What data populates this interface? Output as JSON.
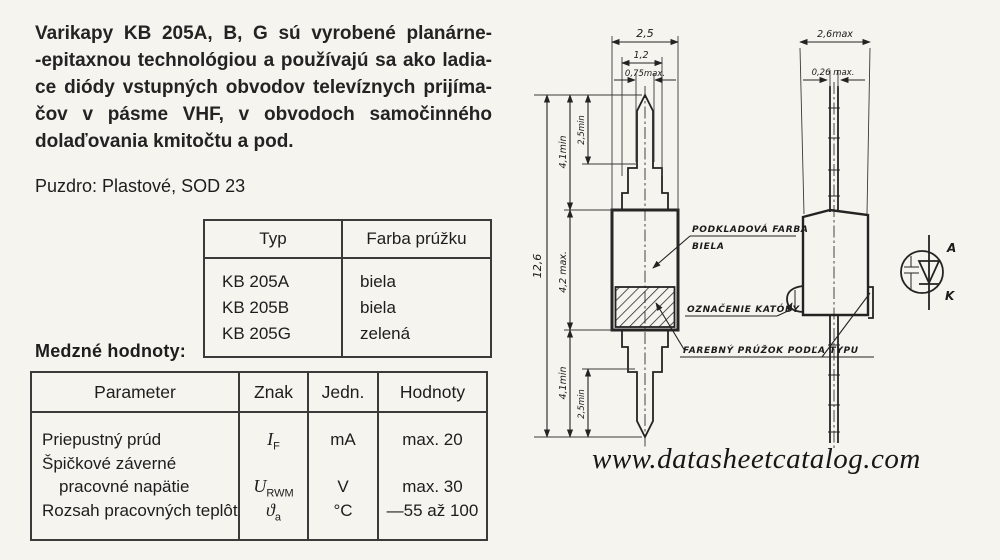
{
  "page": {
    "background": "#f6f4ee",
    "ink": "#1d1d1d"
  },
  "intro": {
    "lines": [
      "Varikapy KB 205A, B, G sú vyrobené planárne-",
      "-epitaxnou technológiou a používajú sa ako ladia-",
      "ce diódy vstupných obvodov televíznych prijíma-",
      "čov v pásme VHF, v obvodoch samočinného",
      "dolaďovania kmitočtu a pod."
    ]
  },
  "package_line": "Puzdro: Plastové, SOD 23",
  "type_table": {
    "headers": [
      "Typ",
      "Farba prúžku"
    ],
    "rows": [
      [
        "KB 205A",
        "biela"
      ],
      [
        "KB 205B",
        "biela"
      ],
      [
        "KB 205G",
        "zelená"
      ]
    ]
  },
  "limits": {
    "title": "Medzné hodnoty:",
    "headers": [
      "Parameter",
      "Znak",
      "Jedn.",
      "Hodnoty"
    ],
    "rows": [
      {
        "parameter": "Priepustný prúd",
        "symbol": "I",
        "symbol_sub": "F",
        "unit": "mA",
        "value": "max. 20"
      },
      {
        "parameter": "Špičkové záverné",
        "parameter2": "pracovné napätie",
        "symbol": "U",
        "symbol_sub": "RWM",
        "unit": "V",
        "value": "max. 30"
      },
      {
        "parameter": "Rozsah pracovných teplôt",
        "symbol": "ϑ",
        "symbol_sub": "a",
        "unit": "°C",
        "value": "—55 až 100"
      }
    ]
  },
  "drawing": {
    "front_view": {
      "dim_body_width": "2,5",
      "dim_collar_width": "1,2",
      "dim_lead_width": "0,75max.",
      "dim_total_length": "12,6",
      "dim_lead_top": "4,1min",
      "dim_tip_top": "2,5min",
      "dim_body_length": "4,2 max.",
      "dim_lead_bottom": "4,1min",
      "dim_tip_bottom": "2,5min"
    },
    "side_view": {
      "dim_body_width": "2,6max",
      "dim_lead_width": "0,26 max."
    },
    "callouts": {
      "base_color_line1": "PODKLADOVÁ FARBA",
      "base_color_line2": "BIELA",
      "cathode_mark": "OZNAČENIE KATÓDY",
      "color_stripe": "FAREBNÝ PRÚŽOK PODĽA TYPU"
    },
    "symbol": {
      "anode": "A",
      "cathode": "K"
    }
  },
  "watermark": "www.datasheetcatalog.com"
}
